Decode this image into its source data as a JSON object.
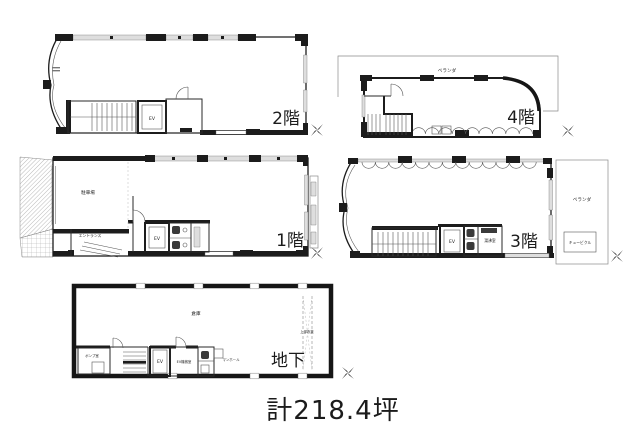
{
  "caption": "計218.4坪",
  "floors": [
    {
      "id": "2f",
      "label": "2階",
      "rooms": {
        "ev": "EV"
      }
    },
    {
      "id": "4f",
      "label": "4階",
      "rooms": {
        "veranda": "ベランダ"
      }
    },
    {
      "id": "1f",
      "label": "1階",
      "rooms": {
        "parking": "駐車場",
        "entrance": "エントランス",
        "ev": "EV"
      }
    },
    {
      "id": "3f",
      "label": "3階",
      "rooms": {
        "veranda": "ベランダ",
        "cubicle": "キュービクル",
        "ev": "EV",
        "kitchenette": "湯沸室"
      }
    },
    {
      "id": "b1",
      "label": "地下",
      "rooms": {
        "warehouse": "倉庫",
        "pump_room": "ポンプ室",
        "ev": "EV",
        "ev_machine_room": "EV機械室",
        "manhole": "マンホール",
        "void_above": "上部吹抜"
      }
    }
  ],
  "icons": {
    "north_mark": "four-point-star"
  },
  "colors": {
    "ink": "#1b1b1b",
    "window_fill": "#dedede",
    "hatch": "#9a9a9a",
    "background": "#ffffff"
  }
}
